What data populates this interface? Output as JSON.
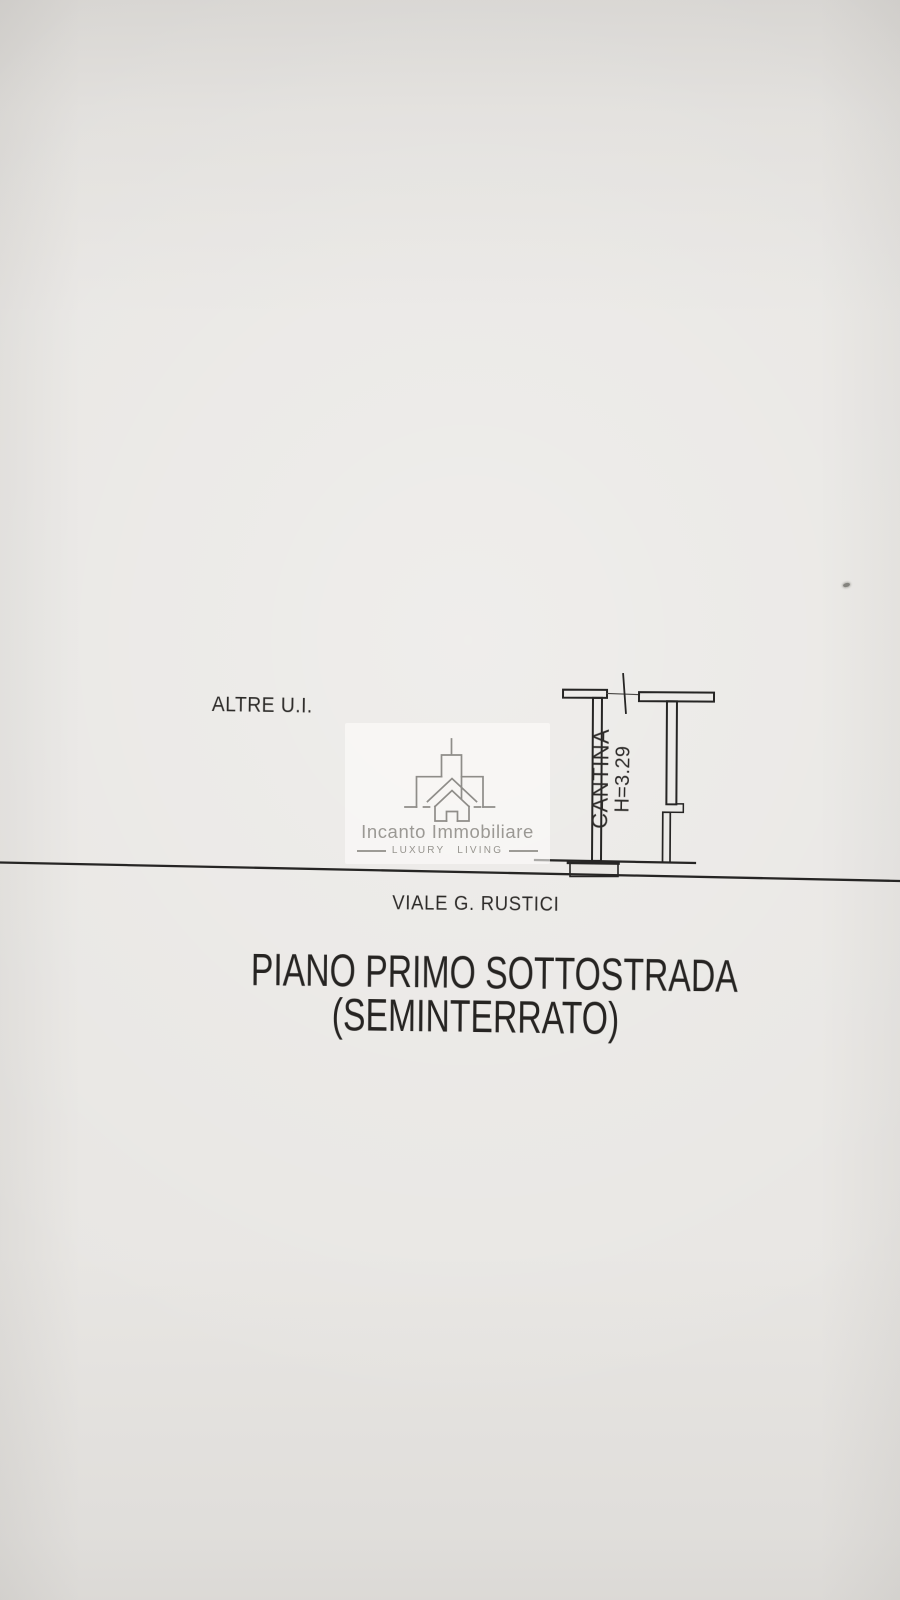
{
  "page": {
    "area_label": "ALTRE U.I.",
    "room_label": "CANTINA",
    "room_height": "H=3.29",
    "street_name": "VIALE G. RUSTICI",
    "title_line1": "PIANO PRIMO SOTTOSTRADA",
    "title_line2": "(SEMINTERRATO)"
  },
  "watermark": {
    "brand": "Incanto Immobiliare",
    "tagline": "LUXURY LIVING"
  },
  "icons": {
    "watermark_logo": "estate-building-line-icon"
  },
  "colors": {
    "paper": "#e8e6e3",
    "ink": "#2c2a28",
    "plan_line": "#262524",
    "watermark_gray": "#8f8d89"
  }
}
